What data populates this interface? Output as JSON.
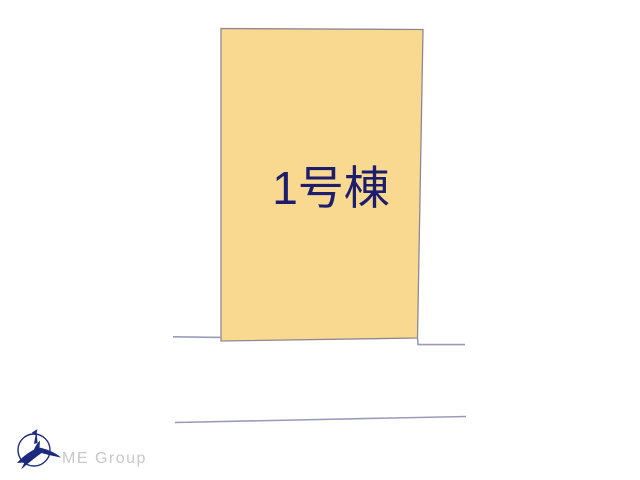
{
  "plan": {
    "plot_label": "1号棟"
  },
  "logo": {
    "company_name": "ME Group"
  },
  "colors": {
    "background": "#ffffff",
    "plot_fill": "#f9d98f",
    "plot_border": "#8f8894",
    "plot_label": "#1d1d6e",
    "boundary_line": "#9b9bb8",
    "logo_navy": "#1b2a7e",
    "logo_text": "#c8c8c8"
  }
}
